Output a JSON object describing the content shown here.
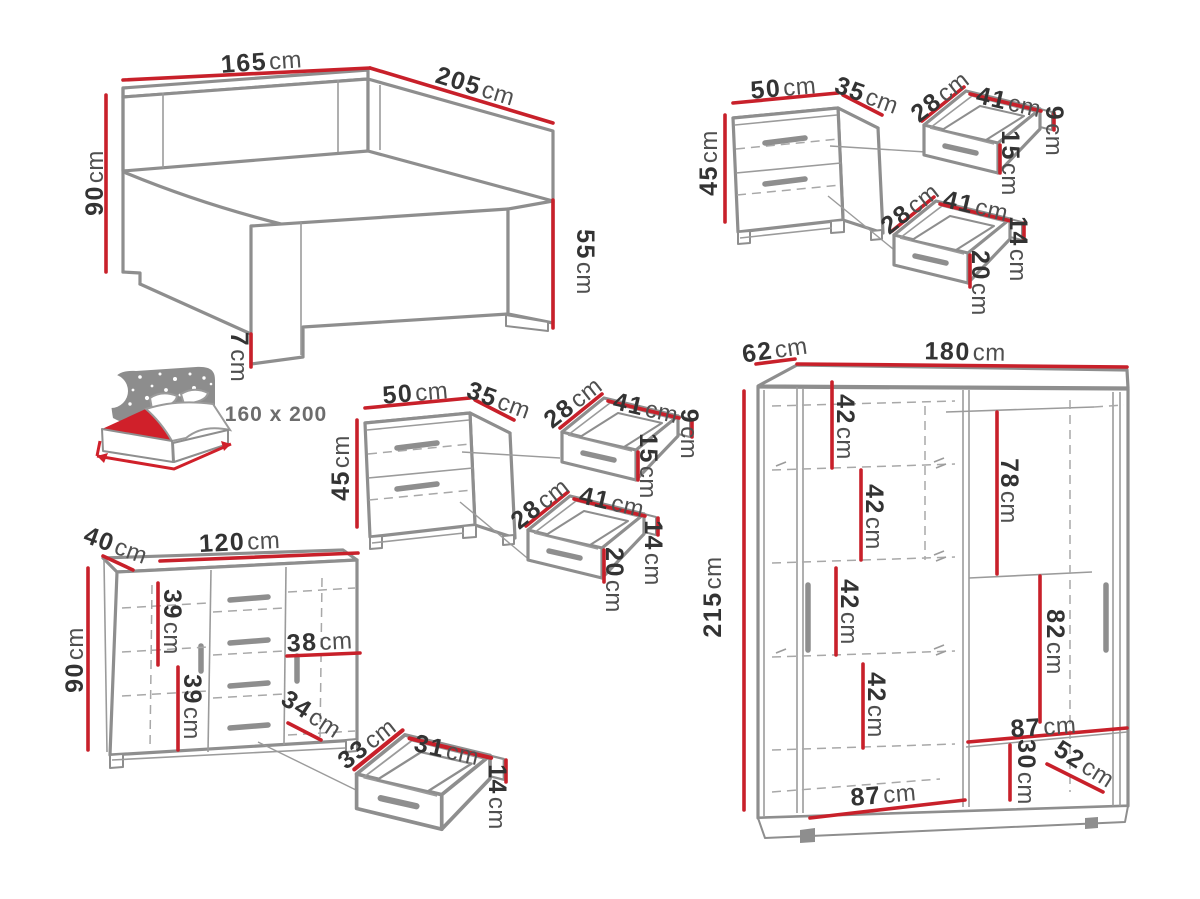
{
  "colors": {
    "dimension_line": "#c8202a",
    "furniture_line": "#8e8e8e",
    "label_number": "#333333",
    "label_unit": "#4f4f4f"
  },
  "bed": {
    "width": {
      "v": "165",
      "u": "cm"
    },
    "length": {
      "v": "205",
      "u": "cm"
    },
    "headboard_height": {
      "v": "90",
      "u": "cm"
    },
    "footboard_height": {
      "v": "55",
      "u": "cm"
    },
    "leg_height": {
      "v": "7",
      "u": "cm"
    },
    "mattress_size": "160 x 200"
  },
  "nightstand_right": {
    "width": {
      "v": "50",
      "u": "cm"
    },
    "depth": {
      "v": "35",
      "u": "cm"
    },
    "height": {
      "v": "45",
      "u": "cm"
    },
    "top_drawer": {
      "depth": {
        "v": "28",
        "u": "cm"
      },
      "width": {
        "v": "41",
        "u": "cm"
      },
      "back_height": {
        "v": "9",
        "u": "cm"
      },
      "front_height": {
        "v": "15",
        "u": "cm"
      }
    },
    "bottom_drawer": {
      "depth": {
        "v": "28",
        "u": "cm"
      },
      "width": {
        "v": "41",
        "u": "cm"
      },
      "back_height": {
        "v": "14",
        "u": "cm"
      },
      "front_height": {
        "v": "20",
        "u": "cm"
      }
    }
  },
  "nightstand_left": {
    "width": {
      "v": "50",
      "u": "cm"
    },
    "depth": {
      "v": "35",
      "u": "cm"
    },
    "height": {
      "v": "45",
      "u": "cm"
    },
    "top_drawer": {
      "depth": {
        "v": "28",
        "u": "cm"
      },
      "width": {
        "v": "41",
        "u": "cm"
      },
      "back_height": {
        "v": "9",
        "u": "cm"
      },
      "front_height": {
        "v": "15",
        "u": "cm"
      }
    },
    "bottom_drawer": {
      "depth": {
        "v": "28",
        "u": "cm"
      },
      "width": {
        "v": "41",
        "u": "cm"
      },
      "back_height": {
        "v": "14",
        "u": "cm"
      },
      "front_height": {
        "v": "20",
        "u": "cm"
      }
    }
  },
  "dresser": {
    "depth": {
      "v": "40",
      "u": "cm"
    },
    "width": {
      "v": "120",
      "u": "cm"
    },
    "height": {
      "v": "90",
      "u": "cm"
    },
    "upper_section_height": {
      "v": "39",
      "u": "cm"
    },
    "lower_section_height": {
      "v": "39",
      "u": "cm"
    },
    "door_width": {
      "v": "38",
      "u": "cm"
    },
    "door_inner_width": {
      "v": "34",
      "u": "cm"
    },
    "drawer": {
      "depth": {
        "v": "33",
        "u": "cm"
      },
      "width": {
        "v": "31",
        "u": "cm"
      },
      "height": {
        "v": "14",
        "u": "cm"
      }
    }
  },
  "wardrobe": {
    "depth": {
      "v": "62",
      "u": "cm"
    },
    "width": {
      "v": "180",
      "u": "cm"
    },
    "height": {
      "v": "215",
      "u": "cm"
    },
    "shelf_1": {
      "v": "42",
      "u": "cm"
    },
    "shelf_2": {
      "v": "42",
      "u": "cm"
    },
    "shelf_3": {
      "v": "42",
      "u": "cm"
    },
    "shelf_4": {
      "v": "42",
      "u": "cm"
    },
    "hanging_top": {
      "v": "78",
      "u": "cm"
    },
    "hanging_bottom": {
      "v": "82",
      "u": "cm"
    },
    "right_section_width": {
      "v": "87",
      "u": "cm"
    },
    "bottom_shelf_height": {
      "v": "30",
      "u": "cm"
    },
    "bottom_shelf_depth": {
      "v": "52",
      "u": "cm"
    },
    "left_section_width": {
      "v": "87",
      "u": "cm"
    }
  }
}
